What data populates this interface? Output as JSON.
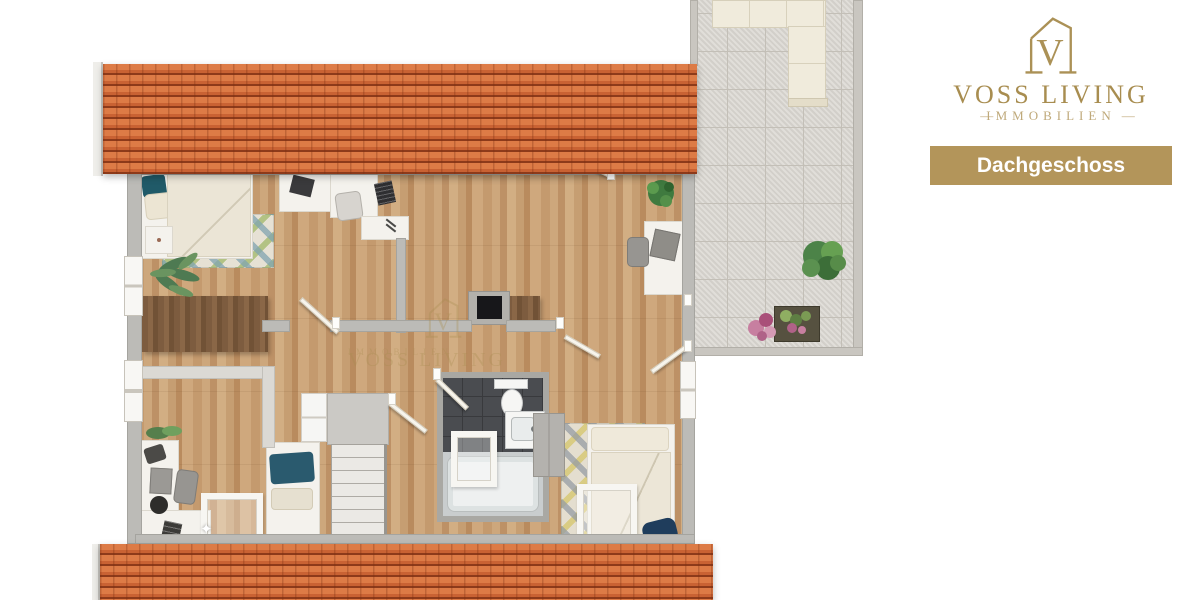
{
  "brand": {
    "monogram": "V",
    "name": "VOSS LIVING",
    "tagline": "IMMOBILIEN",
    "tagline_left": "—",
    "tagline_right": "—"
  },
  "floor_banner": {
    "label": "Dachgeschoss"
  },
  "watermark": {
    "monogram": "V",
    "name": "VOSS LIVING",
    "tagline": "IMMOBILIEN"
  },
  "palette": {
    "brand_gold": "#a88d50",
    "brand_gold_light": "#bfa97a",
    "banner_bg": "#b3955a",
    "banner_text": "#ffffff",
    "roof_tile": "#cf6a38",
    "roof_shadow": "#8d3a1a",
    "wood_floor": "#c7a076",
    "dark_wood": "#7d5c3f",
    "terrace_tile": "#d9d6d0",
    "wall_gray": "#bcbbb7",
    "bath_tile": "#4a4c50",
    "accent_navy": "#24536a",
    "rug_green": "#a0b969",
    "rug_blue": "#80a4b0",
    "rug_yellow": "#d6c56a"
  }
}
